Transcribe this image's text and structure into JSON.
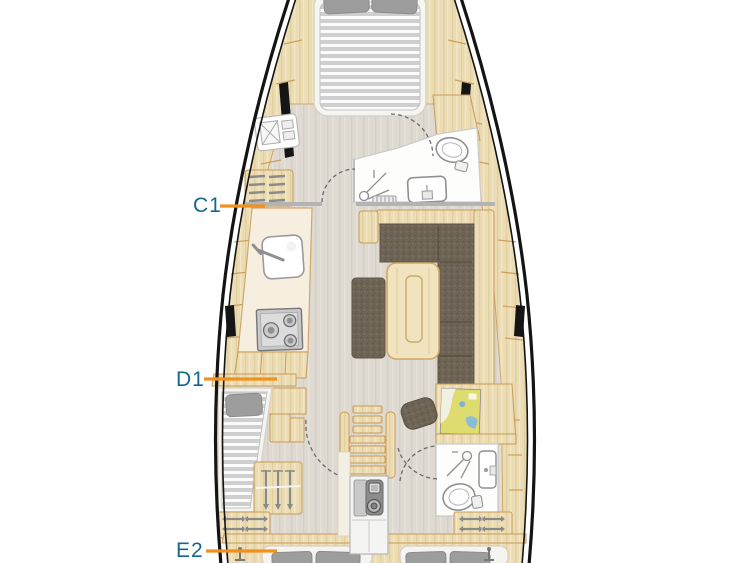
{
  "diagram": {
    "type": "yacht-interior-floor-plan",
    "cabin_labels": [
      {
        "code": "C1"
      },
      {
        "code": "D1"
      },
      {
        "code": "E2"
      }
    ]
  },
  "colors": {
    "label_text": "#16688a",
    "pointer_line": "#f0901d",
    "hull_outline": "#141414",
    "wood": "#ecdcb4",
    "wood_border": "#c79a58",
    "floor": "#dedad2",
    "upholstery": "#6f6556",
    "counter": "#f6efdf",
    "mattress_gray": "#cfcfcf",
    "fixture_stroke": "#8f8f8f"
  }
}
